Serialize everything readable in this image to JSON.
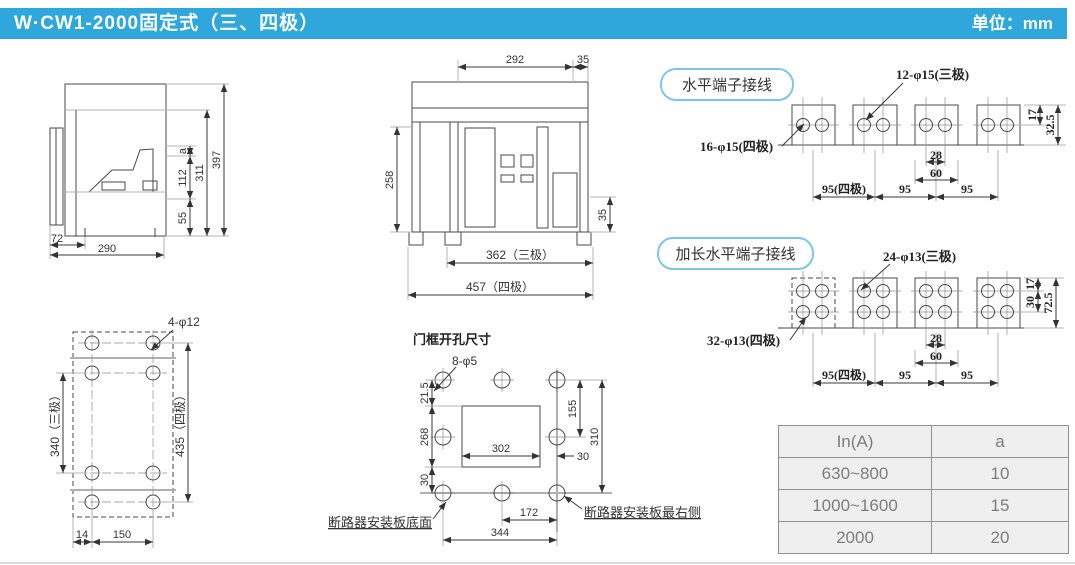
{
  "colors": {
    "header_bg": "#2fa7dc",
    "header_text": "#ffffff",
    "pill_border": "#7cc6e8",
    "drawing_line": "#4a4a4a",
    "construction_line": "#b5b5b5",
    "dim_text": "#333333",
    "table_border": "#919191",
    "table_bg": "#efefef",
    "table_text": "#7d7d7d"
  },
  "header": {
    "title": "W·CW1-2000固定式（三、四极）",
    "unit": "单位：mm"
  },
  "side_view": {
    "d397": "397",
    "d311": "311",
    "da": "a",
    "d112": "112",
    "d55": "55",
    "d72": "72",
    "d290": "290"
  },
  "front_view": {
    "d292": "292",
    "d35_top": "35",
    "d258": "258",
    "d35_right": "35",
    "d362": "362（三极）",
    "d457": "457（四极）"
  },
  "horizontal_terminal": {
    "label": "水平端子接线",
    "callout_3p": "12-φ15(三极)",
    "callout_4p": "16-φ15(四极)",
    "d17": "17",
    "d32_5": "32.5",
    "d28": "28",
    "d60": "60",
    "d95_4p": "95(四极)",
    "d95_mid": "95",
    "d95_right": "95"
  },
  "extended_terminal": {
    "label": "加长水平端子接线",
    "callout_3p": "24-φ13(三极)",
    "callout_4p": "32-φ13(四极)",
    "d30": "30",
    "d17": "17",
    "d72_5": "72.5",
    "d28": "28",
    "d60": "60",
    "d95_4p": "95(四极)",
    "d95_mid": "95",
    "d95_right": "95"
  },
  "mounting_plate": {
    "callout": "4-φ12",
    "d340": "340（三极）",
    "d435": "435（四极）",
    "d14": "14",
    "d150": "150"
  },
  "door_cutout": {
    "title": "门框开孔尺寸",
    "callout": "8-φ5",
    "d21_5": "21.5",
    "d268": "268",
    "d30_left": "30",
    "d155": "155",
    "d310": "310",
    "d302": "302",
    "d30_right": "30",
    "d172": "172",
    "d344": "344",
    "note_bottom": "断路器安装板底面",
    "note_right": "断路器安装板最右侧"
  },
  "spec_table": {
    "headers": [
      "In(A)",
      "a"
    ],
    "rows": [
      [
        "630~800",
        "10"
      ],
      [
        "1000~1600",
        "15"
      ],
      [
        "2000",
        "20"
      ]
    ]
  }
}
